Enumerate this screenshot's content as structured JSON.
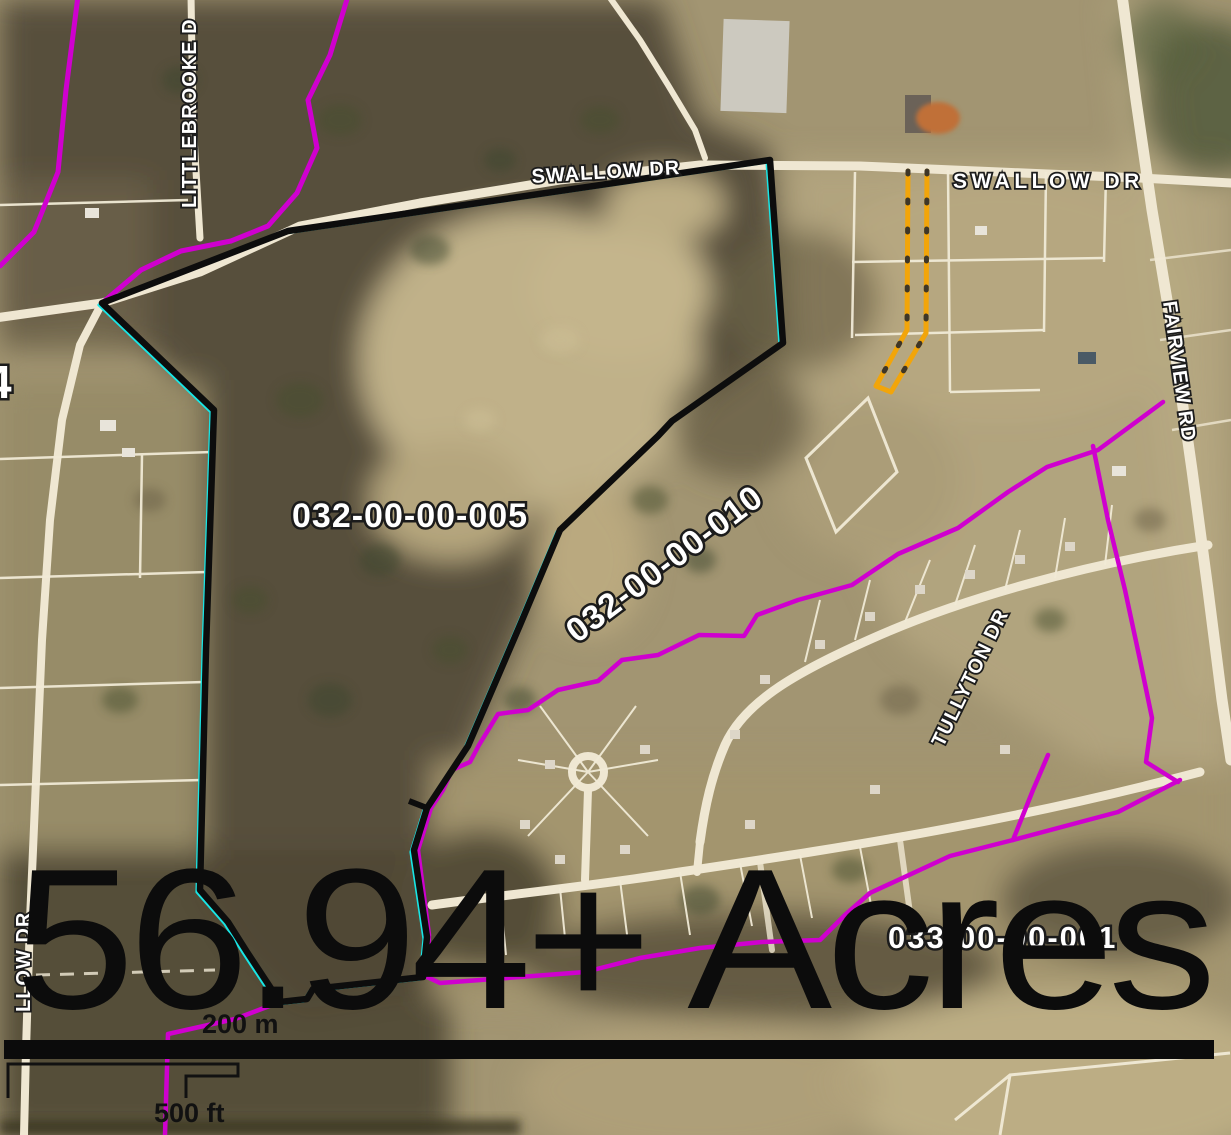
{
  "map": {
    "acreage_text": "56.94+ Acres",
    "parcel_labels": {
      "main": "032-00-00-005",
      "east": "032-00-00-010",
      "south": "033-00-00-001",
      "edge_partial": "4"
    },
    "street_labels": {
      "swallow_west": "SWALLOW DR",
      "swallow_east": "SWALLOW DR",
      "fairview": "FAIRVIEW RD",
      "littlebrooke": "LITTLEBROOKE D",
      "llow": "LLOW DR",
      "tullyton": "TULLYTON DR"
    },
    "scale_bar": {
      "metric": "200 m",
      "imperial": "500 ft"
    },
    "colors": {
      "subject_outline": "#0d0d0d",
      "subject_highlight": "#18e6e6",
      "parcel_boundary": "#cf00cf",
      "flag_lot_highlight": "#f2a50a",
      "road_fill": "#efe7d2"
    }
  }
}
